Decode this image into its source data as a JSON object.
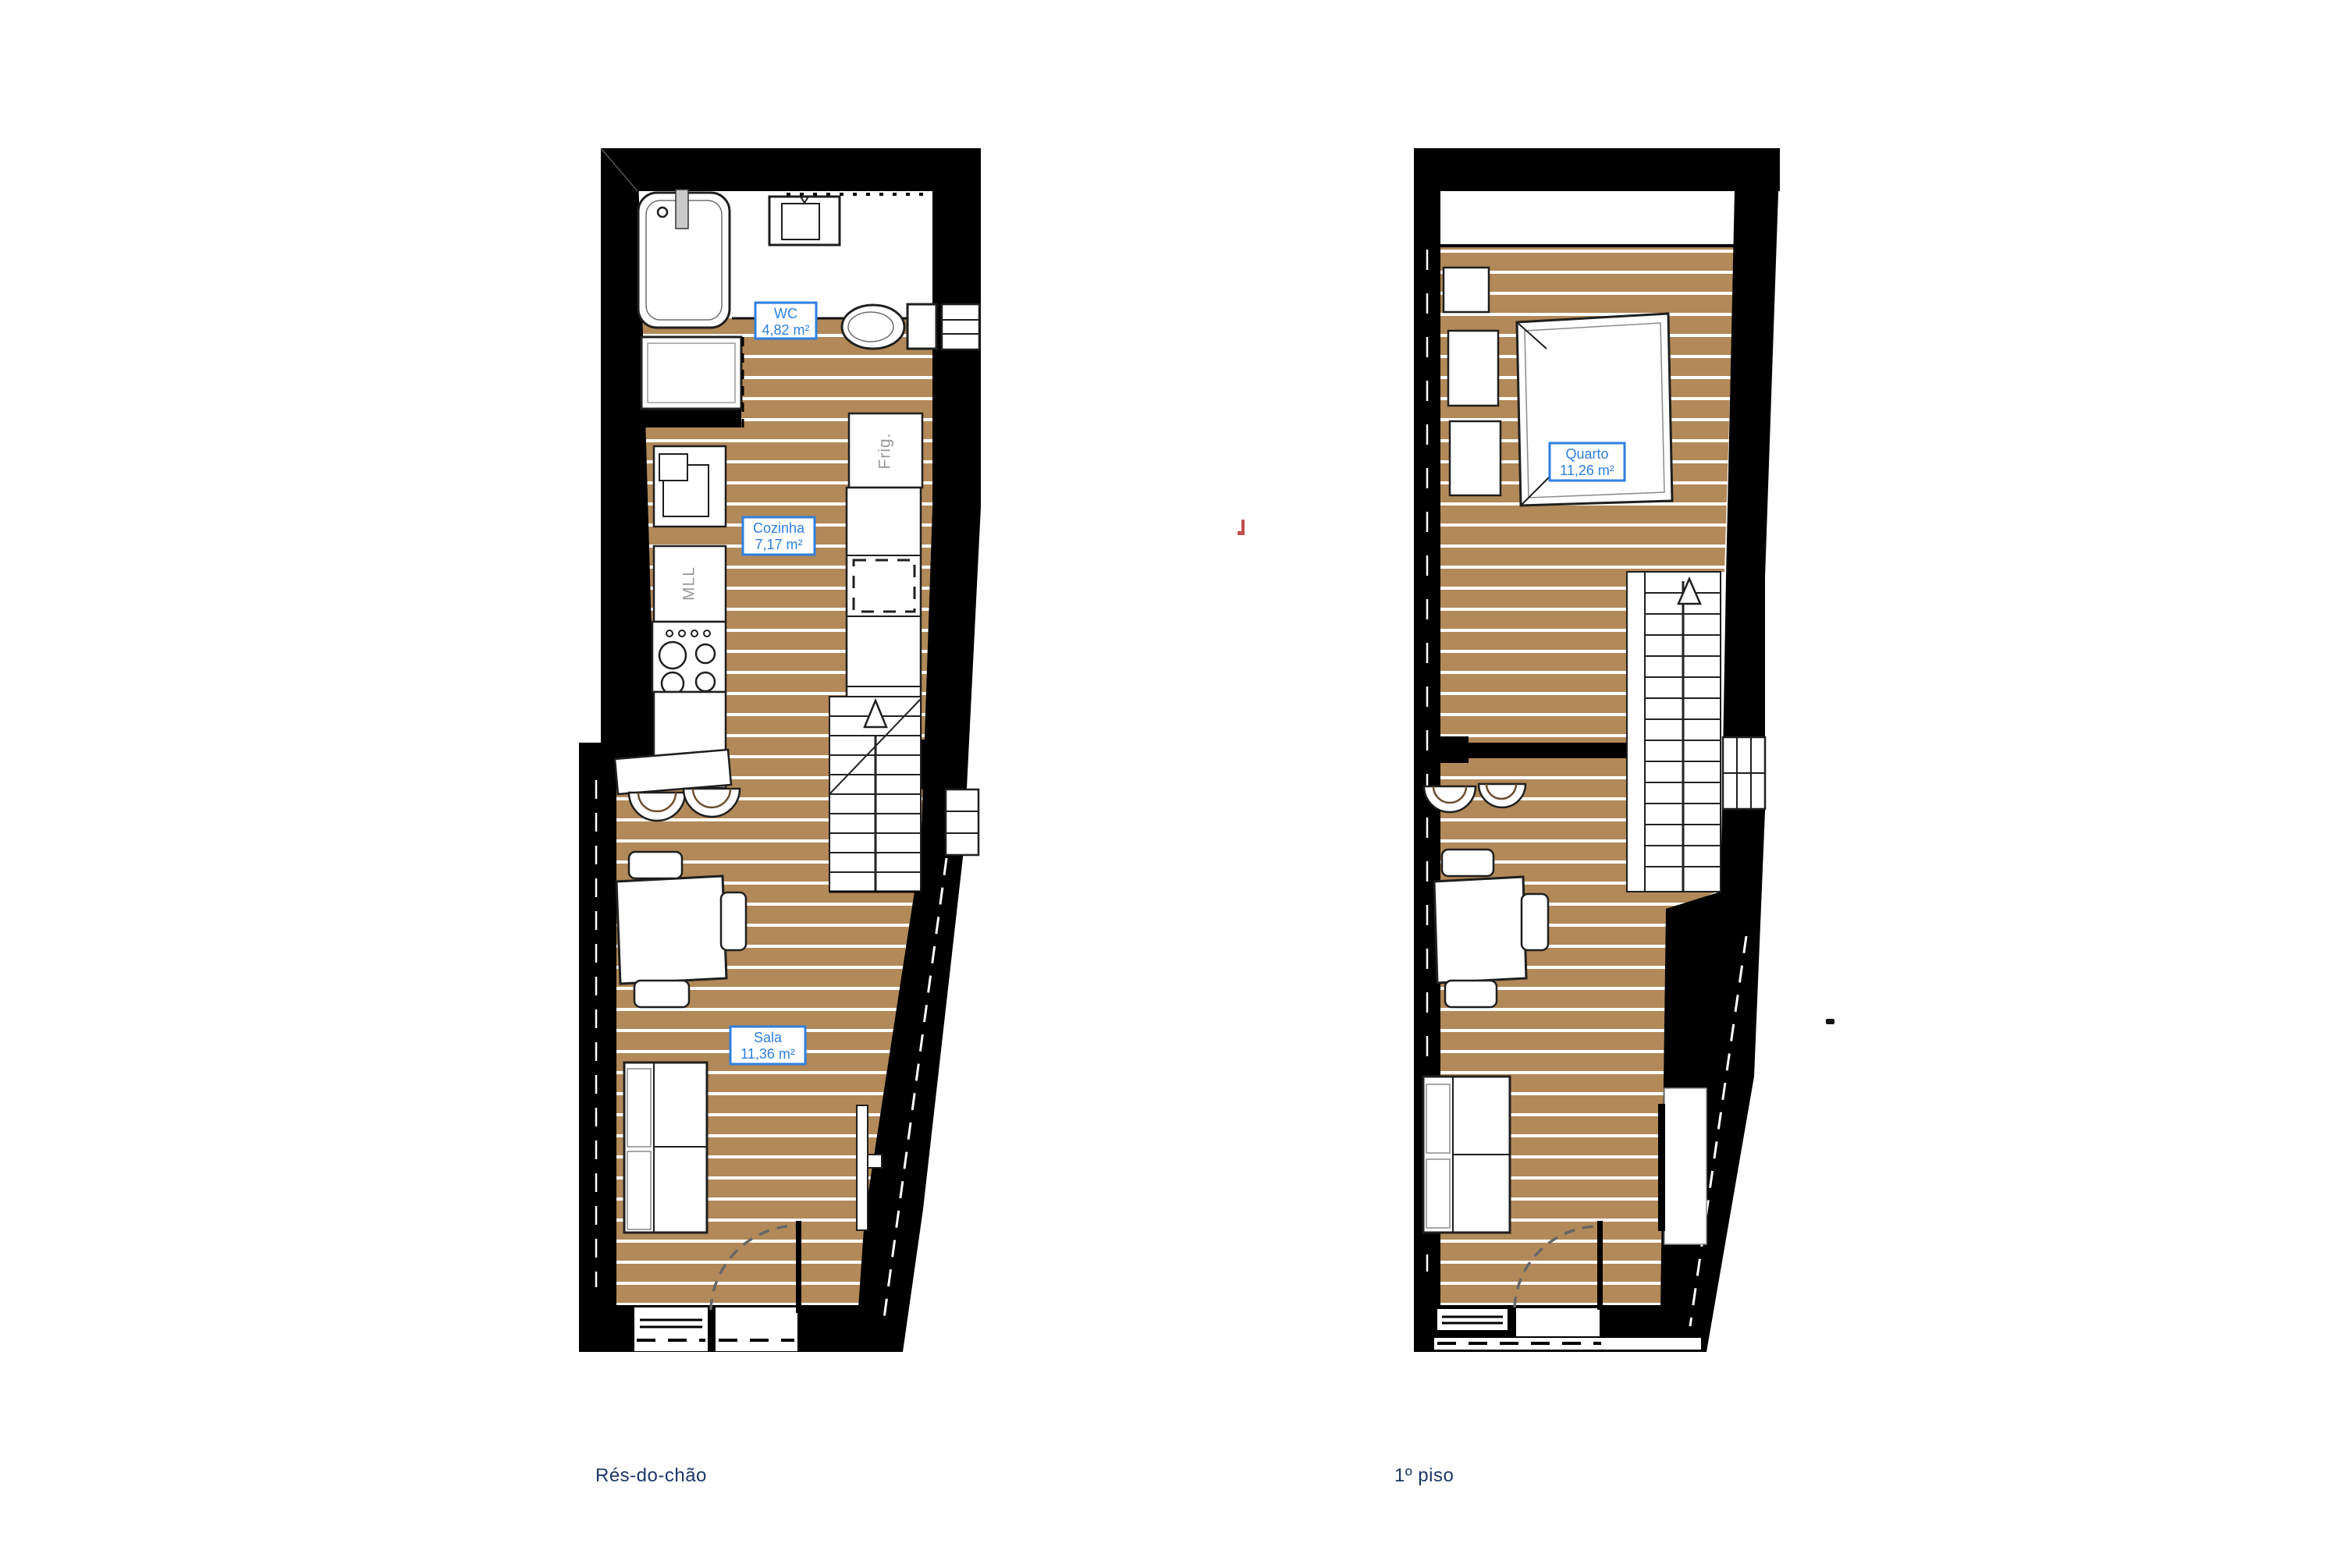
{
  "document": {
    "type": "architectural floor plan, two storeys",
    "background": "#ffffff"
  },
  "palette": {
    "wall": "#000000",
    "floor_wood": "#b28958",
    "plank_line": "#ffffff",
    "furniture_fill": "#ffffff",
    "furniture_stroke": "#1f1f1f",
    "label_blue": "#2f7fe0",
    "caption_navy": "#1b3767",
    "appliance_gray": "#9a9a9a",
    "stray_mark_red": "#c0504d"
  },
  "plans": {
    "ground": {
      "caption": "Rés-do-chão",
      "rooms": [
        {
          "name": "WC",
          "area": "4,82 m²"
        },
        {
          "name": "Cozinha",
          "area": "7,17 m²"
        },
        {
          "name": "Sala",
          "area": "11,36 m²"
        }
      ],
      "appliances": {
        "fridge": "Frig.",
        "washer": "MLL"
      }
    },
    "first": {
      "caption": "1º piso",
      "rooms": [
        {
          "name": "Quarto",
          "area": "11,26 m²"
        }
      ]
    }
  }
}
